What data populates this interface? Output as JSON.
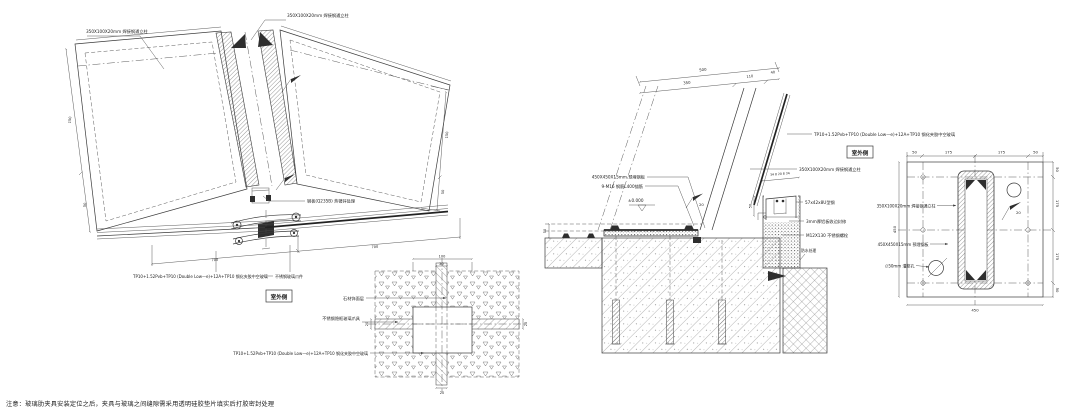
{
  "sheet": {
    "ink": "#3a3a3a",
    "note": "注意：玻璃肋夹具安装定位之后，夹具与玻璃之间缝隙需采用透明硅胶垫片填实后打胶密封处理"
  },
  "labels": {
    "outdoor": "室外侧"
  },
  "specs": {
    "glass": "TP10+1.52Pvb+TP10 (Double Low—e)+12A+TP10 钢化夹胶中空玻璃",
    "mullion": "350X100X20mm 焊接钢通立柱",
    "embed": "450X450X15mm 预埋钢板"
  },
  "left_view": {
    "ann_clamp": "不锈钢玻璃爪件",
    "ann_steel_plate": "钢板(Q235B) 热镀锌处理",
    "dims": {
      "left_a": "150",
      "left_b": "50",
      "right_a": "150",
      "right_b": "50",
      "bottom_a": "700",
      "bottom_b": "700"
    }
  },
  "plan_detail": {
    "ann_finish": "石材饰面层",
    "ann_clamp": "不锈钢隐框玻璃爪具",
    "dims": {
      "w": "100",
      "t": "20",
      "left": "20",
      "right": "20",
      "bottom": "20"
    }
  },
  "section": {
    "dims": {
      "total": "500",
      "back": "350",
      "mid": "110",
      "front": "40",
      "head": "34 8 20 8 34",
      "head_h": "50",
      "left_h": "50"
    },
    "elev": "±0.000",
    "weld": "20",
    "ann_anchor": "9-M16 钢筋L400锚筋",
    "ann_channel": "57x42x8U型钢",
    "ann_trim": "3mm厚铝板收边封修",
    "ann_bolt": "M12X130 不锈钢螺栓",
    "ann_wp": "防水处理"
  },
  "plate_plan": {
    "dims_top": [
      "50",
      "175",
      "175",
      "50"
    ],
    "dims_right": [
      "50",
      "175",
      "175",
      "50"
    ],
    "dim_left": "450",
    "dim_bottom": "450",
    "ann_hole": "∅50mm 灌浆孔",
    "weld": "20"
  }
}
